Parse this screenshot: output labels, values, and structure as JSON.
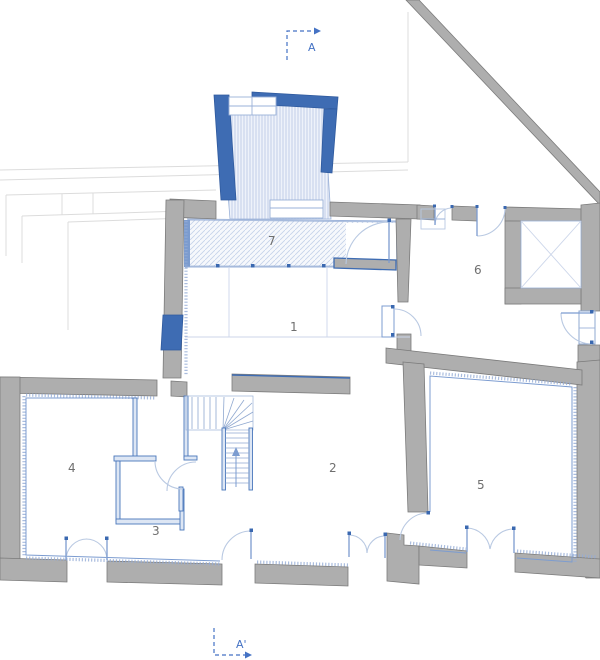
{
  "drawing": {
    "kind": "architectural-floor-plan",
    "rooms": [
      {
        "id": "room-1",
        "label": "1"
      },
      {
        "id": "room-2",
        "label": "2"
      },
      {
        "id": "room-3",
        "label": "3"
      },
      {
        "id": "room-4",
        "label": "4"
      },
      {
        "id": "room-5",
        "label": "5"
      },
      {
        "id": "room-6",
        "label": "6"
      },
      {
        "id": "room-7",
        "label": "7"
      }
    ],
    "section_markers": {
      "top_label": "A",
      "bottom_label": "A'"
    },
    "colors": {
      "wall_gray": "#aeaeae",
      "wall_stroke": "#7b7b7b",
      "accent_blue": "#3e6cb3",
      "light_blue": "#9ab1d8",
      "hatch_blue": "#b7c7e4",
      "door_arc_blue": "#b9c9e2",
      "room_label_gray": "#6f6f6f",
      "context_gray": "#dcdcdc"
    }
  }
}
